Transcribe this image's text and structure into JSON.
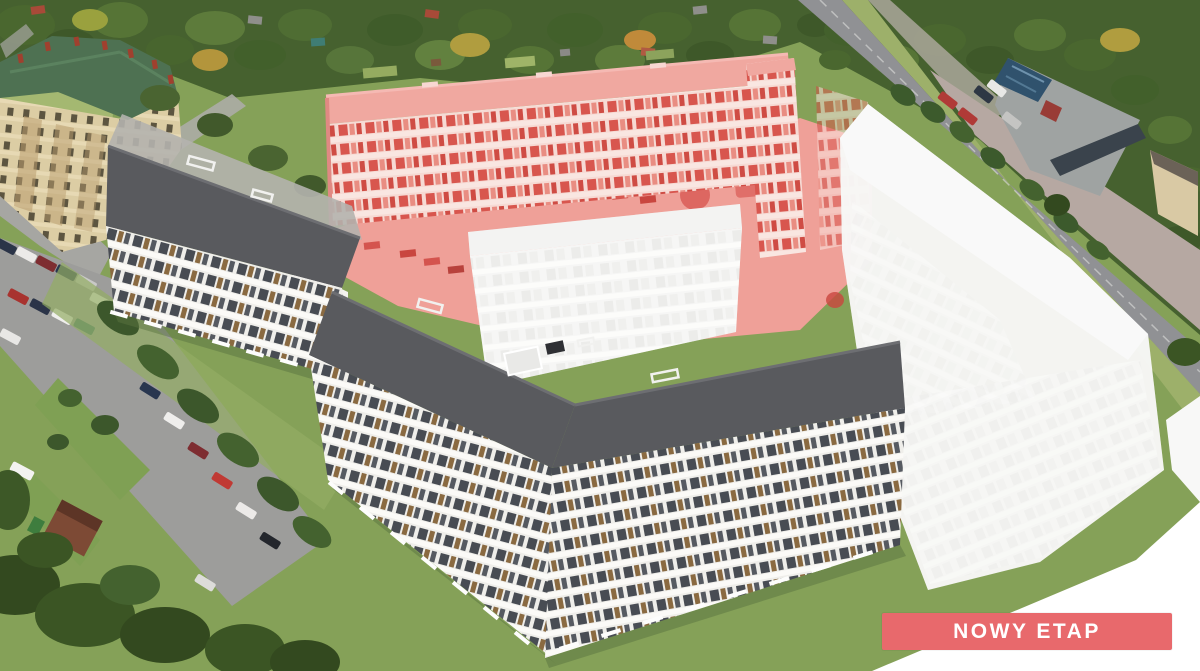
{
  "badge": {
    "label": "NOWY ETAP"
  },
  "colors": {
    "badge_bg": "#e8696c",
    "badge_text": "#ffffff",
    "highlight_wall": "#f6dad4",
    "highlight_window": "#d8564e",
    "highlight_accent": "#e98d82",
    "highlight_ground": "#efa098",
    "highlight_roof": "#f0a8a0",
    "roof_dark": "#595a5e",
    "facade_white": "#efeeea",
    "facade_window": "#484c53",
    "wood_accent": "#8a6a41",
    "ghost_white": "#f2f2f0",
    "ghost_window": "#e2e2df",
    "grass": "#85a158",
    "asphalt": "#9d9d9b",
    "road": "#909194",
    "tree_dark": "#46612f",
    "existing_roof": "#4e7152",
    "existing_facade": "#dccda4",
    "fade_white": "#ffffff"
  }
}
